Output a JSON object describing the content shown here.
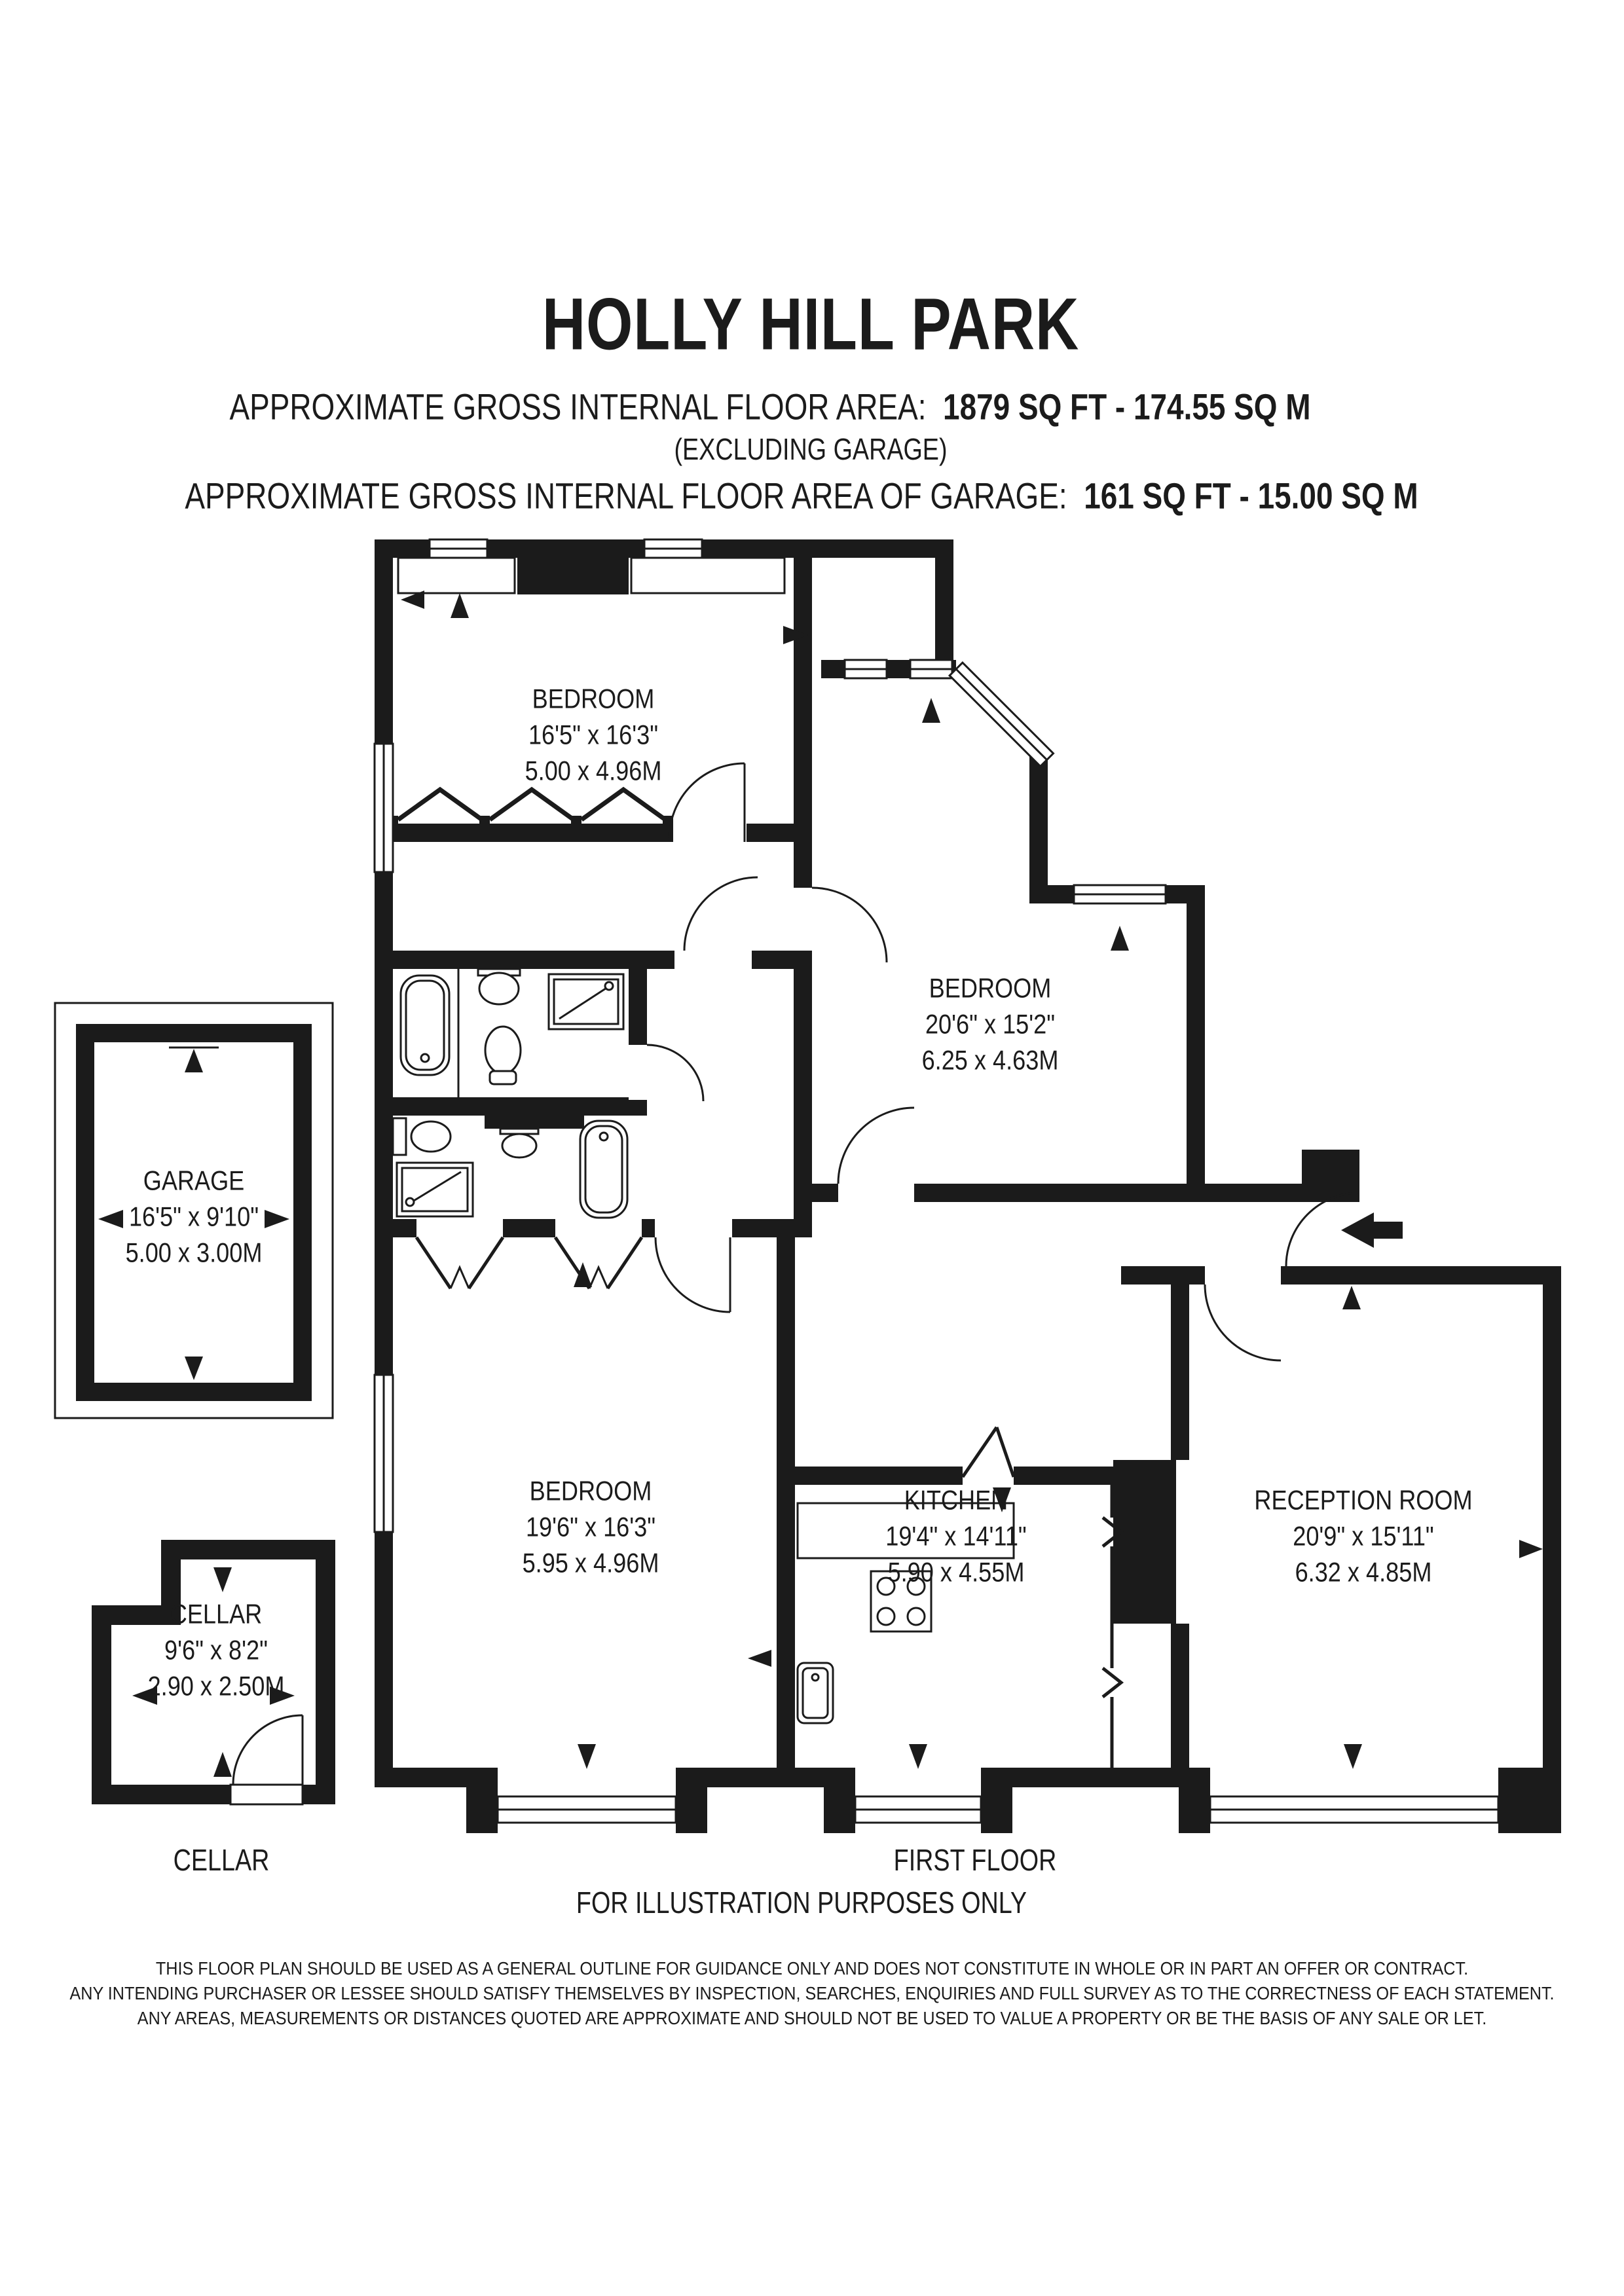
{
  "header": {
    "title": "HOLLY HILL PARK",
    "area_label": "APPROXIMATE GROSS INTERNAL FLOOR AREA:",
    "area_value": "1879 SQ FT  -  174.55 SQ M",
    "excluding_note": "(EXCLUDING GARAGE)",
    "garage_area_label": "APPROXIMATE GROSS INTERNAL FLOOR AREA OF GARAGE:",
    "garage_area_value": "161 SQ FT  -  15.00 SQ M"
  },
  "rooms": {
    "bedroom1": {
      "name": "BEDROOM",
      "imperial": "16'5\" x 16'3\"",
      "metric": "5.00 x 4.96M"
    },
    "bedroom2": {
      "name": "BEDROOM",
      "imperial": "20'6\" x 15'2\"",
      "metric": "6.25 x 4.63M"
    },
    "garage": {
      "name": "GARAGE",
      "imperial": "16'5\" x 9'10\"",
      "metric": "5.00 x 3.00M"
    },
    "bedroom3": {
      "name": "BEDROOM",
      "imperial": "19'6\" x 16'3\"",
      "metric": "5.95 x 4.96M"
    },
    "kitchen": {
      "name": "KITCHEN",
      "imperial": "19'4\" x 14'11\"",
      "metric": "5.90 x 4.55M"
    },
    "reception": {
      "name": "RECEPTION ROOM",
      "imperial": "20'9\" x 15'11\"",
      "metric": "6.32 x 4.85M"
    },
    "cellar": {
      "name": "CELLAR",
      "imperial": "9'6\" x 8'2\"",
      "metric": "2.90 x 2.50M"
    }
  },
  "footer": {
    "cellar_label": "CELLAR",
    "floor_label": "FIRST FLOOR",
    "illustration_note": "FOR ILLUSTRATION PURPOSES ONLY",
    "disclaimer_line1": "THIS FLOOR PLAN SHOULD BE USED AS A GENERAL OUTLINE FOR GUIDANCE ONLY AND DOES NOT CONSTITUTE IN WHOLE OR IN PART AN OFFER OR CONTRACT.",
    "disclaimer_line2": "ANY INTENDING PURCHASER OR LESSEE SHOULD SATISFY THEMSELVES BY INSPECTION, SEARCHES, ENQUIRIES AND FULL SURVEY AS TO THE CORRECTNESS OF EACH STATEMENT.",
    "disclaimer_line3": "ANY AREAS, MEASUREMENTS OR DISTANCES QUOTED ARE APPROXIMATE AND SHOULD NOT BE USED TO VALUE A PROPERTY OR BE THE BASIS OF ANY SALE OR LET."
  },
  "colors": {
    "wall": "#1b1b1b",
    "background": "#ffffff"
  }
}
